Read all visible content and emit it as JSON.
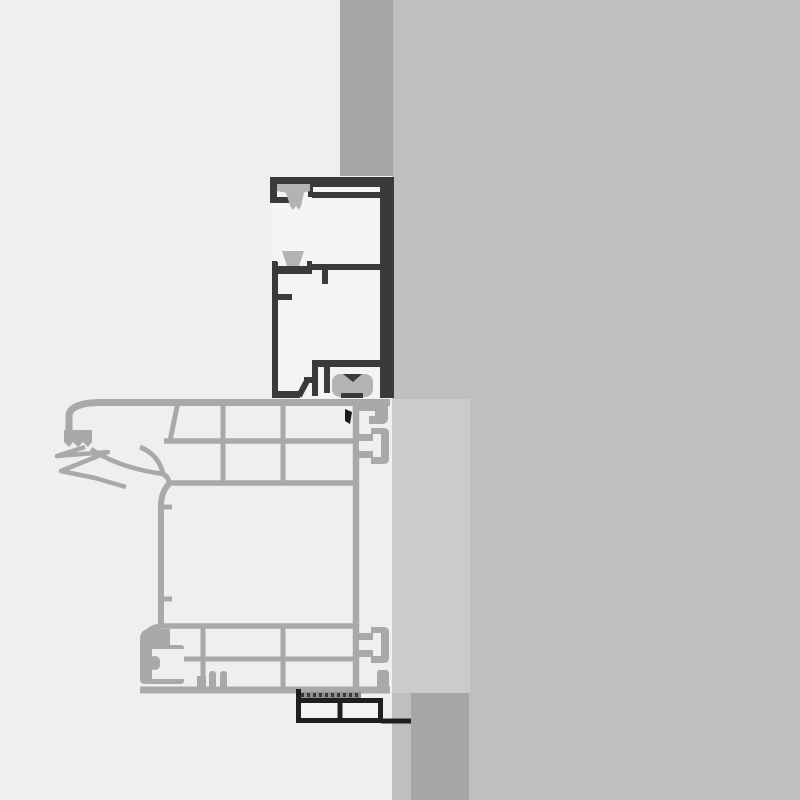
{
  "diagram": {
    "kind": "technical cross-section drawing",
    "subject": "window frame installation detail at wall reveal",
    "orientation": "vertical section",
    "parts": {
      "wall_upper": "wall reveal strip (above frame)",
      "wall_lower": "wall strip (below sill)",
      "frame_profile": "outer frame profile (dark outline) with seal gaskets",
      "top_gasket": "upper compression gasket",
      "mid_gasket": "middle wedge gasket",
      "foot_gasket": "overlap foot gasket on sash",
      "sash_profile": "multi-chamber sash / sill profile (light gray)",
      "left_gasket_cluster": "flexible lip gasket at outer sash edge",
      "hardware_groove": "C-shaped hardware groove",
      "glazing_panel": "panel / glazing edge rectangle",
      "compression_strip": "hatched compression tape under sash",
      "bead_profile": "two-chamber bead / track profile (dark outline)",
      "clip_black": "small black fixing clip"
    }
  },
  "colors": {
    "bg_left": "#efefef",
    "bg_right": "#bfbfbf",
    "wall": "#a6a6a6",
    "panel": "#cbcbcb",
    "sash_stroke": "#a9a9a9",
    "frame_dark": "#3a3a3a",
    "frame_fill": "#f4f4f4",
    "gasket": "#b3b3b3",
    "detail_black": "#1a1a1a",
    "bead_stroke": "#1f1f1f",
    "hatch": "#8f8f8f"
  }
}
